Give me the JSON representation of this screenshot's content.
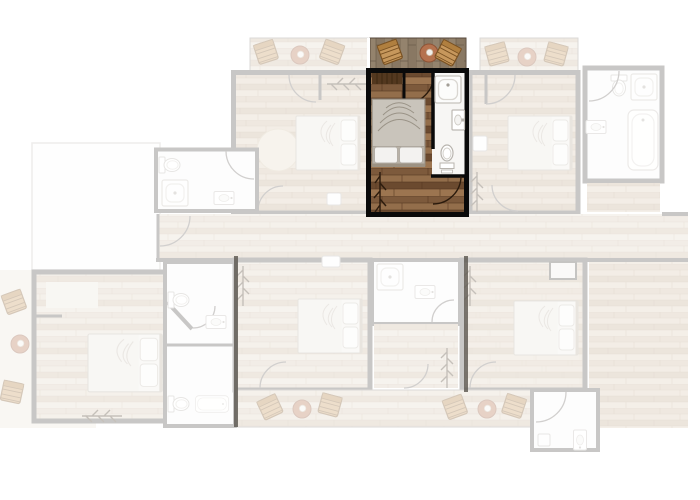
{
  "colors": {
    "background": "#ffffff",
    "highlight_outline": "#0a0a0a",
    "highlight_wood_base": "#8a6544",
    "deck_wood": "#8d7c67",
    "faded_wall_gray": "#54504b",
    "bathroom_white": "#f7f6f4",
    "bed_duvet": "#c9c4bb",
    "pillow_white": "#f3f2f0",
    "chair_wood": "#c6975c",
    "table_terracotta": "#b5724e",
    "faded_wood": "#d3c0a8",
    "rug_cream": "#e6d9c5",
    "closet_wood": "#53381f"
  },
  "highlighted_unit": {
    "bedroom": {
      "floor": "dark-wood-planks",
      "items": [
        "double-bed",
        "wardrobe",
        "coat-rack",
        "door-arc"
      ]
    },
    "bathroom": {
      "floor": "white",
      "items": [
        "shower",
        "washbasin",
        "toilet",
        "door-arc"
      ]
    },
    "balcony": {
      "floor": "wood-deck",
      "items": [
        "wood-chair",
        "round-table",
        "wood-chair"
      ]
    }
  },
  "faded_context": {
    "top_balconies": [
      {
        "name": "balcony-upper-left",
        "items": [
          "wood-chair",
          "round-table",
          "wood-chair"
        ]
      },
      {
        "name": "balcony-upper-right",
        "items": [
          "wood-chair",
          "round-table",
          "wood-chair"
        ]
      }
    ],
    "upper_rooms": [
      {
        "name": "upper-left-room",
        "items": [
          "double-bed",
          "round-rug",
          "coat-rack",
          "wall-item"
        ]
      },
      {
        "name": "upper-right-room",
        "items": [
          "double-bed",
          "coat-rack",
          "wall-cabinet"
        ]
      }
    ],
    "bathrooms": [
      {
        "name": "upper-left-bathroom",
        "items": [
          "toilet",
          "shower",
          "washbasin"
        ]
      },
      {
        "name": "upper-right-bathroom",
        "items": [
          "toilet",
          "shower",
          "bathtub",
          "washbasin"
        ]
      },
      {
        "name": "mid-bathroom-column",
        "items": [
          "toilet",
          "washbasin",
          "bathtub",
          "toilet"
        ]
      },
      {
        "name": "lower-right-bathroom",
        "items": [
          "washbasin",
          "cabinet"
        ]
      }
    ],
    "corridor": {
      "name": "corridor"
    },
    "lower_rooms": [
      {
        "name": "lower-left-room",
        "items": [
          "double-bed",
          "coat-rack",
          "wardrobe"
        ]
      },
      {
        "name": "lower-middle-room",
        "items": [
          "double-bed",
          "coat-rack",
          "wall-item"
        ]
      },
      {
        "name": "lower-right-room",
        "items": [
          "double-bed",
          "coat-rack",
          "shower-cabinet"
        ]
      }
    ],
    "lower_balconies": [
      {
        "name": "balcony-lower-left",
        "items": [
          "wood-chair",
          "round-table",
          "wood-chair"
        ]
      },
      {
        "name": "balcony-lower-right",
        "items": [
          "wood-chair",
          "round-table",
          "wood-chair"
        ]
      }
    ],
    "left_terrace": {
      "name": "left-terrace",
      "items": [
        "wood-chair",
        "round-table",
        "wood-chair"
      ]
    },
    "upper_left_roof_terrace": {
      "name": "roof-terrace"
    }
  }
}
